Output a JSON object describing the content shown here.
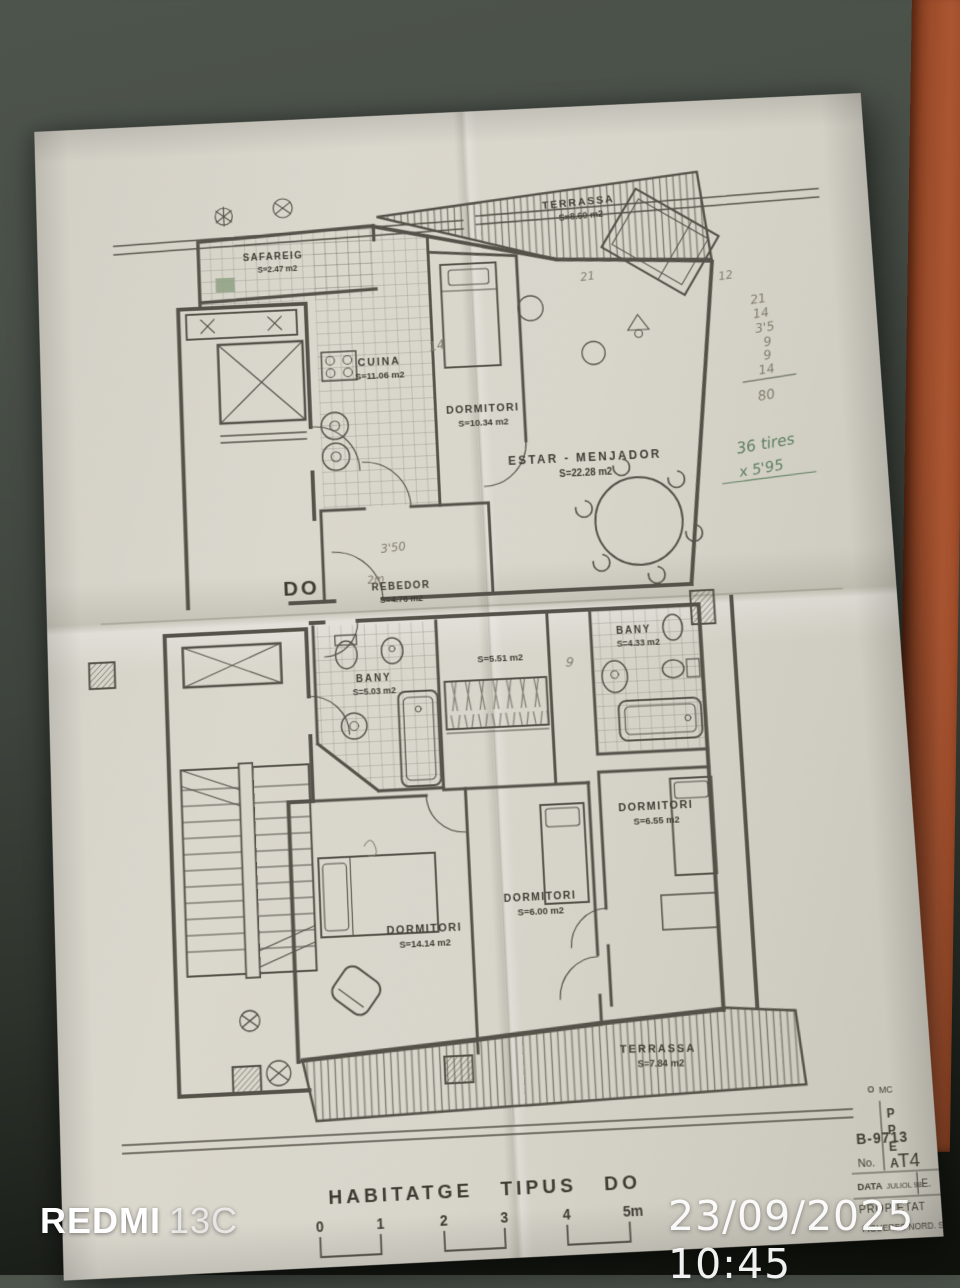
{
  "photo": {
    "watermark_brand": "REDMI",
    "watermark_model": "13C",
    "timestamp": "23/09/2025 10:45"
  },
  "colors": {
    "paper": "#d8d5cb",
    "background_table": "#3e443d",
    "chair_orange": "#a55130",
    "plan_ink": "#55524a",
    "pencil_gray": "#837d6e",
    "pen_green": "#5e7f60",
    "highlight_green": "#8fa184"
  },
  "plan": {
    "sheet_title": "HABITATGE  TIPUS  DO",
    "unit_label": "DO",
    "rooms": [
      {
        "name": "TERRASSA",
        "area": "S=8.60 m2"
      },
      {
        "name": "SAFAREIG",
        "area": "S=2.47 m2"
      },
      {
        "name": "CUINA",
        "area": "S=11.06 m2"
      },
      {
        "name": "DORMITORI",
        "area": "S=10.34 m2"
      },
      {
        "name": "ESTAR - MENJADOR",
        "area": "S=22.28 m2"
      },
      {
        "name": "REBEDOR",
        "area": "S=4.76 m2"
      },
      {
        "name": "BANY",
        "area": "S=5.03 m2"
      },
      {
        "name": "",
        "area": "S=5.51 m2"
      },
      {
        "name": "BANY",
        "area": "S=4.33 m2"
      },
      {
        "name": "DORMITORI",
        "area": "S=14.14 m2"
      },
      {
        "name": "DORMITORI",
        "area": "S=6.00 m2"
      },
      {
        "name": "DORMITORI",
        "area": "S=6.55 m2"
      },
      {
        "name": "TERRASSA",
        "area": "S=7.84 m2"
      }
    ],
    "scale_bar": {
      "labels": [
        "0",
        "1",
        "2",
        "3",
        "4",
        "5m"
      ]
    },
    "title_block": {
      "corner_mark": "MC",
      "partial_letters": [
        "P",
        "P",
        "E",
        "A"
      ],
      "ref": "B-9713",
      "no_label": "No.",
      "no_value": "T4",
      "date_label": "DATA",
      "date_value": "JULIOL 98",
      "e_label": "E.",
      "owner_label": "PROPIETAT",
      "owner_value": "FIGUERES NORD. S.L."
    },
    "handwriting": {
      "tally": [
        "21",
        "14",
        "3'5",
        "9",
        "9",
        "14"
      ],
      "tally_total": "80",
      "note_line1": "36 tires",
      "note_line2": "x 5'95",
      "mark_estar_left": "21",
      "mark_estar_right": "12",
      "mark_dormitori": "14",
      "mark_rebedor_a": "3'50",
      "mark_rebedor_b": "2m",
      "mark_wardrobe": "9"
    }
  }
}
